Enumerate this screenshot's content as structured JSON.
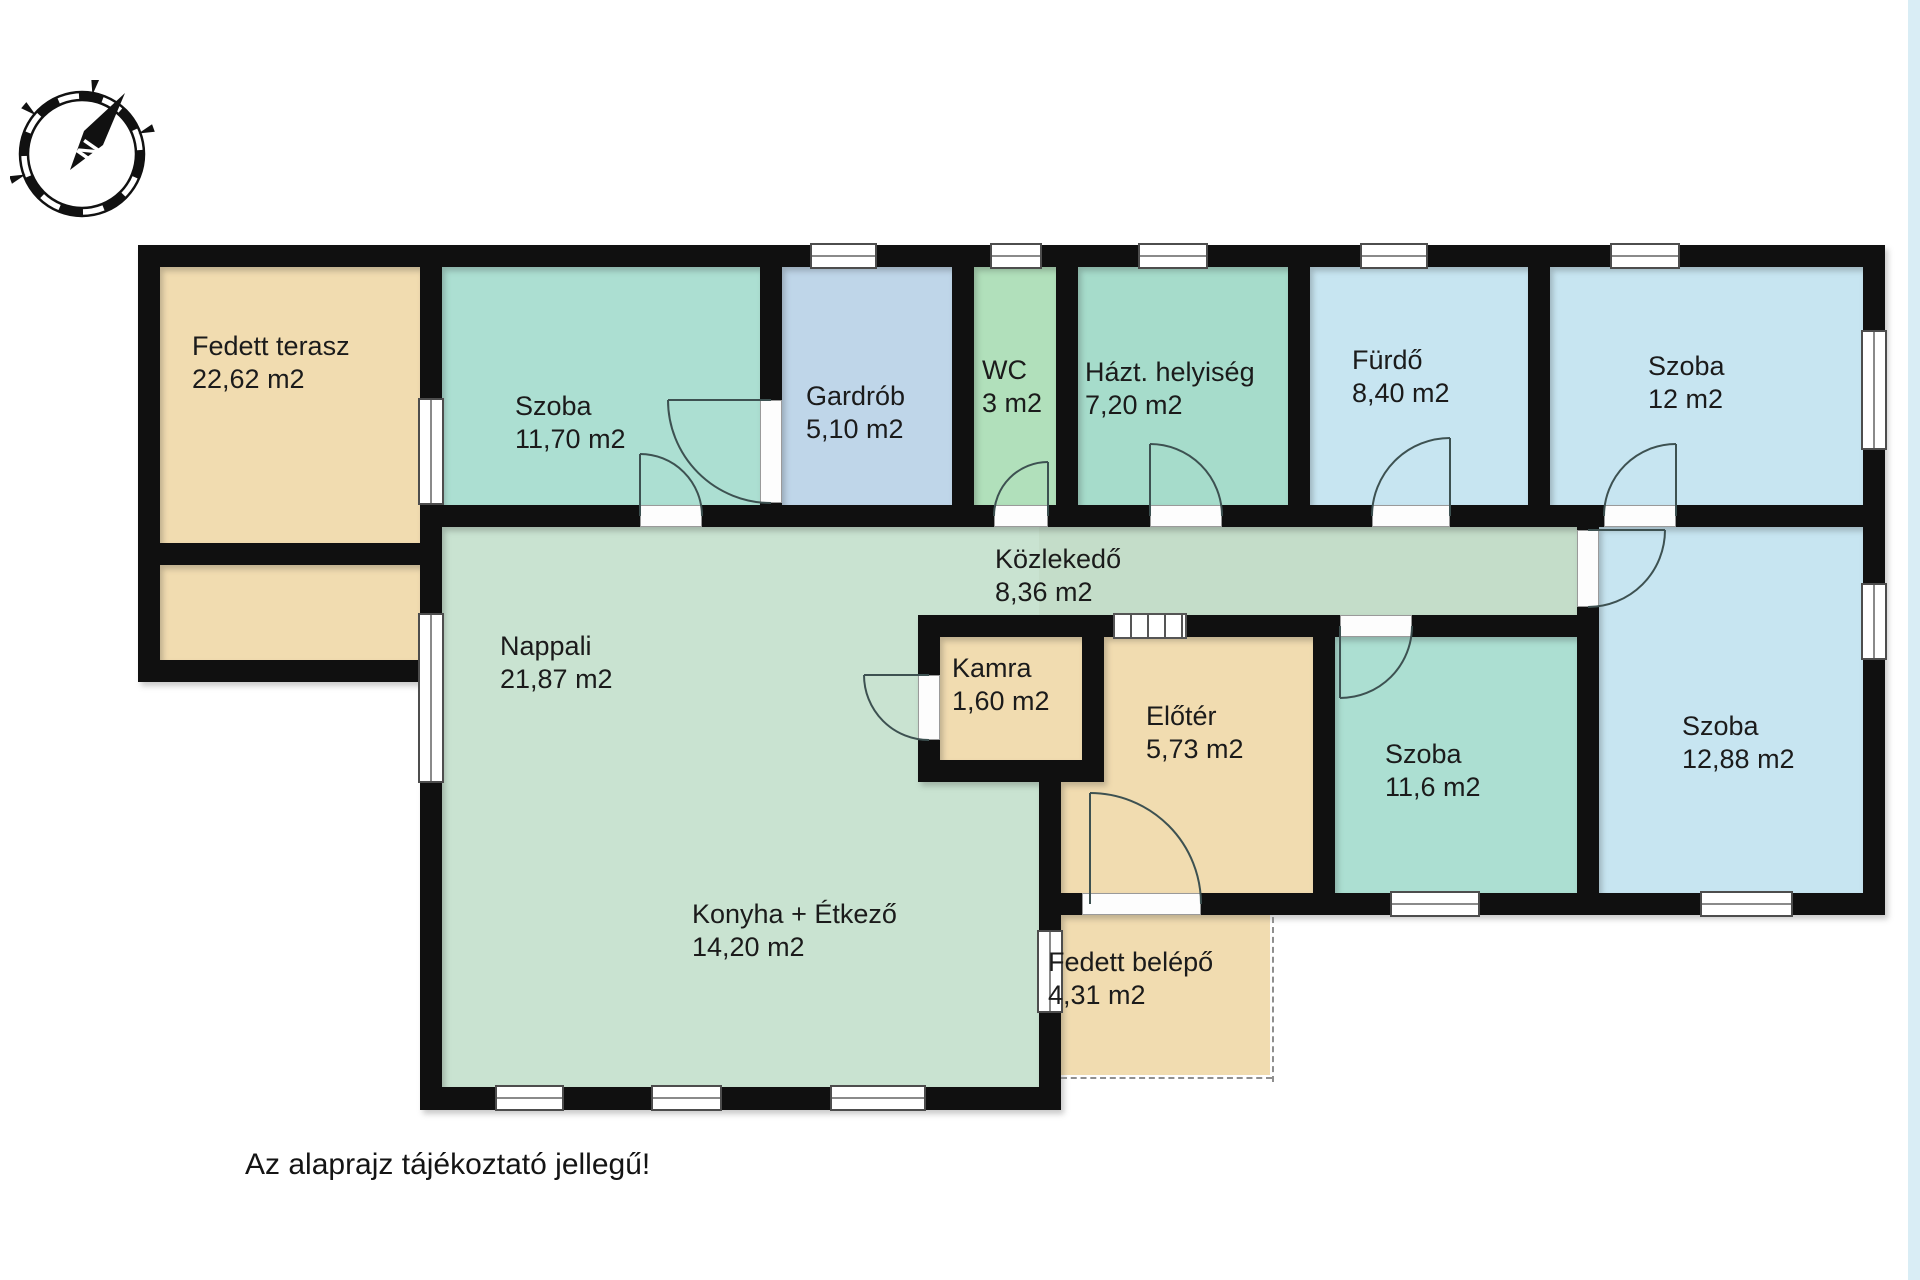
{
  "meta": {
    "note": "Az alaprajz tájékoztató jellegű!",
    "compass_label": "N",
    "area_unit": "m2"
  },
  "palette": {
    "wall": "#101010",
    "tan": "#f1dcb0",
    "teal_room": "#acdfd2",
    "gardrob_blue": "#bfd6e9",
    "wc_green": "#b1e0bb",
    "hazt_teal": "#a6dccb",
    "pale_blue_room": "#c7e5f1",
    "living_green": "#c9e3d1",
    "edge_strip": "#d9edf5"
  },
  "rooms_summary": [
    {
      "name": "Fedett terasz",
      "area": "22,62 m2"
    },
    {
      "name": "Szoba",
      "area": "11,70 m2"
    },
    {
      "name": "Gardrób",
      "area": "5,10 m2"
    },
    {
      "name": "WC",
      "area": "3 m2"
    },
    {
      "name": "Házt. helyiség",
      "area": "7,20 m2"
    },
    {
      "name": "Fürdő",
      "area": "8,40 m2"
    },
    {
      "name": "Szoba",
      "area": "12 m2"
    },
    {
      "name": "Közlekedő",
      "area": "8,36 m2"
    },
    {
      "name": "Nappali",
      "area": "21,87 m2"
    },
    {
      "name": "Konyha + Étkező",
      "area": "14,20 m2"
    },
    {
      "name": "Kamra",
      "area": "1,60 m2"
    },
    {
      "name": "Előtér",
      "area": "5,73 m2"
    },
    {
      "name": "Szoba",
      "area": "11,6 m2"
    },
    {
      "name": "Szoba",
      "area": "12,88 m2"
    },
    {
      "name": "Fedett belépő",
      "area": "4,31 m2"
    }
  ],
  "plan": {
    "fills": [
      {
        "name": "room-fill-fedett-terasz-upper",
        "color": "#f1dcb0",
        "x": 160,
        "y": 267,
        "w": 260,
        "h": 276
      },
      {
        "name": "room-fill-fedett-terasz-lower",
        "color": "#f1dcb0",
        "x": 160,
        "y": 565,
        "w": 260,
        "h": 95
      },
      {
        "name": "room-fill-szoba-1170",
        "color": "#acdfd2",
        "x": 442,
        "y": 267,
        "w": 318,
        "h": 238
      },
      {
        "name": "room-fill-gardrob",
        "color": "#bfd6e9",
        "x": 782,
        "y": 267,
        "w": 170,
        "h": 238
      },
      {
        "name": "room-fill-wc",
        "color": "#b1e0bb",
        "x": 974,
        "y": 267,
        "w": 82,
        "h": 238
      },
      {
        "name": "room-fill-hazt-helyiseg",
        "color": "#a6dccb",
        "x": 1078,
        "y": 267,
        "w": 210,
        "h": 238
      },
      {
        "name": "room-fill-furdo",
        "color": "#c7e5f1",
        "x": 1310,
        "y": 267,
        "w": 218,
        "h": 238
      },
      {
        "name": "room-fill-szoba-12",
        "color": "#c7e5f1",
        "x": 1550,
        "y": 267,
        "w": 313,
        "h": 238
      },
      {
        "name": "room-fill-nappali-konyha",
        "color": "#c9e3d1",
        "x": 442,
        "y": 527,
        "w": 597,
        "h": 560
      },
      {
        "name": "room-fill-kozlekedo",
        "color": "#c4ddc9",
        "x": 1039,
        "y": 527,
        "w": 538,
        "h": 88
      },
      {
        "name": "room-fill-kamra",
        "color": "#f1dcb0",
        "x": 940,
        "y": 637,
        "w": 142,
        "h": 123
      },
      {
        "name": "room-fill-eloter-a",
        "color": "#f1dcb0",
        "x": 1104,
        "y": 637,
        "w": 209,
        "h": 256
      },
      {
        "name": "room-fill-eloter-b",
        "color": "#f1dcb0",
        "x": 1061,
        "y": 782,
        "w": 252,
        "h": 111
      },
      {
        "name": "room-fill-szoba-116",
        "color": "#acdfd2",
        "x": 1335,
        "y": 637,
        "w": 242,
        "h": 256
      },
      {
        "name": "room-fill-szoba-1288",
        "color": "#c7e5f1",
        "x": 1599,
        "y": 527,
        "w": 264,
        "h": 366
      },
      {
        "name": "room-fill-fedett-belepo",
        "color": "#f1dcb0",
        "x": 1061,
        "y": 915,
        "w": 209,
        "h": 160
      }
    ],
    "walls": [
      {
        "x": 138,
        "y": 245,
        "w": 1747,
        "h": 22
      },
      {
        "x": 1863,
        "y": 245,
        "w": 22,
        "h": 670
      },
      {
        "x": 138,
        "y": 245,
        "w": 22,
        "h": 437
      },
      {
        "x": 138,
        "y": 660,
        "w": 304,
        "h": 22
      },
      {
        "x": 160,
        "y": 543,
        "w": 282,
        "h": 22
      },
      {
        "x": 420,
        "y": 245,
        "w": 22,
        "h": 865
      },
      {
        "x": 760,
        "y": 267,
        "w": 22,
        "h": 260
      },
      {
        "x": 952,
        "y": 267,
        "w": 22,
        "h": 260
      },
      {
        "x": 1056,
        "y": 267,
        "w": 22,
        "h": 260
      },
      {
        "x": 1288,
        "y": 267,
        "w": 22,
        "h": 260
      },
      {
        "x": 1528,
        "y": 267,
        "w": 22,
        "h": 260
      },
      {
        "x": 420,
        "y": 505,
        "w": 1465,
        "h": 22
      },
      {
        "x": 918,
        "y": 615,
        "w": 681,
        "h": 22
      },
      {
        "x": 918,
        "y": 615,
        "w": 22,
        "h": 167
      },
      {
        "x": 1082,
        "y": 615,
        "w": 22,
        "h": 167
      },
      {
        "x": 918,
        "y": 760,
        "w": 186,
        "h": 22
      },
      {
        "x": 1039,
        "y": 760,
        "w": 22,
        "h": 350
      },
      {
        "x": 1313,
        "y": 615,
        "w": 22,
        "h": 300
      },
      {
        "x": 1577,
        "y": 505,
        "w": 22,
        "h": 410
      },
      {
        "x": 1039,
        "y": 893,
        "w": 846,
        "h": 22
      },
      {
        "x": 420,
        "y": 1087,
        "w": 641,
        "h": 23
      }
    ],
    "windows": [
      {
        "x": 810,
        "y": 243,
        "w": 67,
        "h": 26,
        "o": "h"
      },
      {
        "x": 990,
        "y": 243,
        "w": 52,
        "h": 26,
        "o": "h"
      },
      {
        "x": 1138,
        "y": 243,
        "w": 70,
        "h": 26,
        "o": "h"
      },
      {
        "x": 1360,
        "y": 243,
        "w": 68,
        "h": 26,
        "o": "h"
      },
      {
        "x": 1610,
        "y": 243,
        "w": 70,
        "h": 26,
        "o": "h"
      },
      {
        "x": 1861,
        "y": 330,
        "w": 26,
        "h": 120,
        "o": "v"
      },
      {
        "x": 1861,
        "y": 583,
        "w": 26,
        "h": 77,
        "o": "v"
      },
      {
        "x": 1390,
        "y": 891,
        "w": 90,
        "h": 26,
        "o": "h"
      },
      {
        "x": 1700,
        "y": 891,
        "w": 93,
        "h": 26,
        "o": "h"
      },
      {
        "x": 418,
        "y": 398,
        "w": 26,
        "h": 107,
        "o": "v"
      },
      {
        "x": 418,
        "y": 613,
        "w": 26,
        "h": 170,
        "o": "v"
      },
      {
        "x": 495,
        "y": 1085,
        "w": 69,
        "h": 26,
        "o": "h"
      },
      {
        "x": 651,
        "y": 1085,
        "w": 71,
        "h": 26,
        "o": "h"
      },
      {
        "x": 830,
        "y": 1085,
        "w": 96,
        "h": 26,
        "o": "h"
      },
      {
        "x": 1037,
        "y": 930,
        "w": 26,
        "h": 83,
        "o": "v"
      }
    ],
    "sills": [
      {
        "x": 640,
        "y": 505,
        "w": 62,
        "h": 22
      },
      {
        "x": 760,
        "y": 400,
        "w": 22,
        "h": 103
      },
      {
        "x": 994,
        "y": 505,
        "w": 54,
        "h": 22
      },
      {
        "x": 1150,
        "y": 505,
        "w": 72,
        "h": 22
      },
      {
        "x": 1372,
        "y": 505,
        "w": 78,
        "h": 22
      },
      {
        "x": 1604,
        "y": 505,
        "w": 72,
        "h": 22
      },
      {
        "x": 1577,
        "y": 530,
        "w": 22,
        "h": 77
      },
      {
        "x": 1340,
        "y": 615,
        "w": 72,
        "h": 22
      },
      {
        "x": 918,
        "y": 675,
        "w": 22,
        "h": 65
      },
      {
        "x": 1082,
        "y": 893,
        "w": 119,
        "h": 22
      }
    ],
    "slide_doors": [
      {
        "x": 1113,
        "y": 613,
        "w": 74,
        "h": 26
      }
    ],
    "dashes": [
      {
        "x": 1270,
        "y": 917,
        "w": 2,
        "h": 165,
        "o": "v"
      },
      {
        "x": 1061,
        "y": 1075,
        "w": 211,
        "h": 2,
        "o": "h"
      }
    ],
    "doors": [
      {
        "name": "door-szoba-1170-kozlekedo",
        "hinge": [
          640,
          516
        ],
        "leaf": [
          640,
          454
        ],
        "end": [
          702,
          516
        ],
        "sweep": 1
      },
      {
        "name": "door-szoba-1170-gardrob",
        "hinge": [
          771,
          400
        ],
        "leaf": [
          668,
          400
        ],
        "end": [
          771,
          503
        ],
        "sweep": 0
      },
      {
        "name": "door-wc",
        "hinge": [
          1048,
          516
        ],
        "leaf": [
          1048,
          462
        ],
        "end": [
          994,
          516
        ],
        "sweep": 0
      },
      {
        "name": "door-hazt-helyiseg",
        "hinge": [
          1150,
          516
        ],
        "leaf": [
          1150,
          444
        ],
        "end": [
          1222,
          516
        ],
        "sweep": 1
      },
      {
        "name": "door-furdo",
        "hinge": [
          1450,
          516
        ],
        "leaf": [
          1450,
          438
        ],
        "end": [
          1372,
          516
        ],
        "sweep": 0
      },
      {
        "name": "door-szoba-12",
        "hinge": [
          1676,
          516
        ],
        "leaf": [
          1676,
          444
        ],
        "end": [
          1604,
          516
        ],
        "sweep": 0
      },
      {
        "name": "door-szoba-1288",
        "hinge": [
          1588,
          530
        ],
        "leaf": [
          1665,
          530
        ],
        "end": [
          1588,
          607
        ],
        "sweep": 1
      },
      {
        "name": "door-szoba-116",
        "hinge": [
          1340,
          626
        ],
        "leaf": [
          1340,
          698
        ],
        "end": [
          1412,
          626
        ],
        "sweep": 0
      },
      {
        "name": "door-kamra",
        "hinge": [
          929,
          675
        ],
        "leaf": [
          864,
          675
        ],
        "end": [
          929,
          740
        ],
        "sweep": 0
      },
      {
        "name": "door-bejarat",
        "hinge": [
          1090,
          904
        ],
        "leaf": [
          1090,
          793
        ],
        "end": [
          1201,
          904
        ],
        "sweep": 1
      }
    ],
    "labels": [
      {
        "name": "label-fedett-terasz",
        "x": 192,
        "y": 330,
        "lines": [
          "Fedett terasz",
          "22,62 m2"
        ]
      },
      {
        "name": "label-szoba-1170",
        "x": 515,
        "y": 390,
        "lines": [
          "Szoba",
          "11,70 m2"
        ]
      },
      {
        "name": "label-gardrob",
        "x": 806,
        "y": 380,
        "lines": [
          "Gardrób",
          "5,10 m2"
        ]
      },
      {
        "name": "label-wc",
        "x": 982,
        "y": 354,
        "lines": [
          "WC",
          "3 m2"
        ]
      },
      {
        "name": "label-hazt-helyiseg",
        "x": 1085,
        "y": 356,
        "lines": [
          "Házt. helyiség",
          "7,20 m2"
        ]
      },
      {
        "name": "label-furdo",
        "x": 1352,
        "y": 344,
        "lines": [
          "Fürdő",
          "8,40 m2"
        ]
      },
      {
        "name": "label-szoba-12",
        "x": 1648,
        "y": 350,
        "lines": [
          "Szoba",
          "12 m2"
        ]
      },
      {
        "name": "label-kozlekedo",
        "x": 995,
        "y": 543,
        "lines": [
          "Közlekedő",
          "8,36 m2"
        ]
      },
      {
        "name": "label-nappali",
        "x": 500,
        "y": 630,
        "lines": [
          "Nappali",
          "21,87 m2"
        ]
      },
      {
        "name": "label-konyha-etkezo",
        "x": 692,
        "y": 898,
        "lines": [
          "Konyha + Étkező",
          "14,20 m2"
        ]
      },
      {
        "name": "label-kamra",
        "x": 952,
        "y": 652,
        "lines": [
          "Kamra",
          "1,60 m2"
        ]
      },
      {
        "name": "label-eloter",
        "x": 1146,
        "y": 700,
        "lines": [
          "Előtér",
          "5,73 m2"
        ]
      },
      {
        "name": "label-szoba-116",
        "x": 1385,
        "y": 738,
        "lines": [
          "Szoba",
          "11,6 m2"
        ]
      },
      {
        "name": "label-szoba-1288",
        "x": 1682,
        "y": 710,
        "lines": [
          "Szoba",
          "12,88 m2"
        ]
      },
      {
        "name": "label-fedett-belepo",
        "x": 1048,
        "y": 946,
        "lines": [
          "Fedett belépő",
          "4,31 m2"
        ]
      }
    ]
  }
}
